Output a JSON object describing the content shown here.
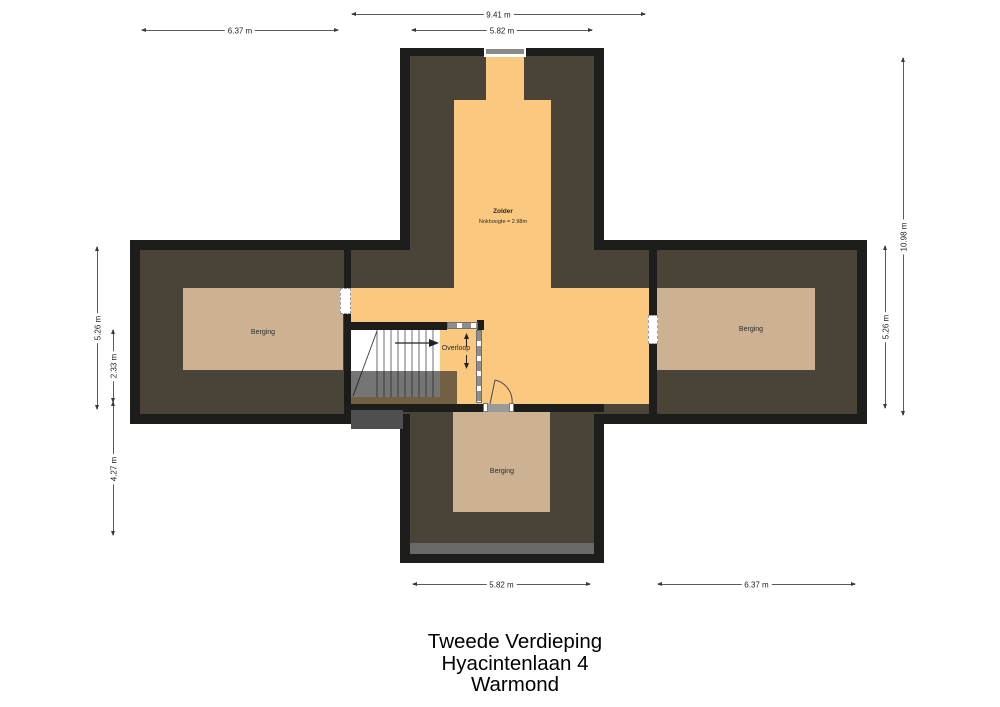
{
  "plan": {
    "rooms": {
      "zolder": {
        "label": "Zolder",
        "note": "Nokhoogte = 2.98m"
      },
      "overloop": {
        "label": "Overloop"
      },
      "berging_left": {
        "label": "Berging"
      },
      "berging_right": {
        "label": "Berging"
      },
      "berging_bottom": {
        "label": "Berging"
      }
    },
    "stairs": {
      "up_arrow": "↑",
      "down_arrow": "↓"
    },
    "dimensions": {
      "top_total": "9.41 m",
      "top_inner": "5.82 m",
      "top_left": "6.37 m",
      "left_outer": "5.26 m",
      "left_inner": "2.33 m",
      "left_lower": "4.27 m",
      "right_total": "10.98 m",
      "right_outer": "5.26 m",
      "bottom_inner": "5.82 m",
      "bottom_right": "6.37 m"
    },
    "colors": {
      "wall": "#1d1d1b",
      "roof_area": "#4a4337",
      "attic_floor": "#fac87e",
      "storage_floor": "#ccb292",
      "dormer_gray": "#696969"
    }
  },
  "title": {
    "line1": "Tweede Verdieping",
    "line2": "Hyacintenlaan 4",
    "line3": "Warmond"
  }
}
